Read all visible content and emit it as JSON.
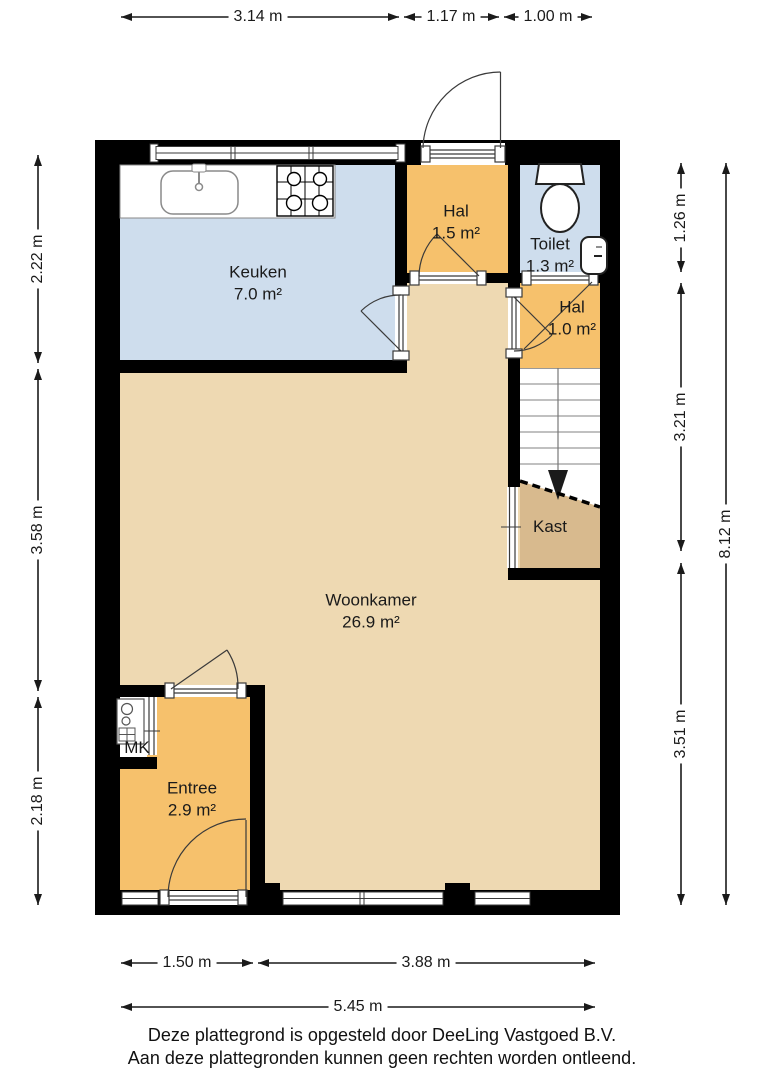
{
  "plan": {
    "rooms": {
      "keuken": {
        "name": "Keuken",
        "area": "7.0 m²"
      },
      "hal_boven": {
        "name": "Hal",
        "area": "1.5 m²"
      },
      "toilet": {
        "name": "Toilet",
        "area": "1.3 m²"
      },
      "hal_onder": {
        "name": "Hal",
        "area": "1.0 m²"
      },
      "kast": {
        "name": "Kast"
      },
      "woonkamer": {
        "name": "Woonkamer",
        "area": "26.9 m²"
      },
      "entree": {
        "name": "Entree",
        "area": "2.9 m²"
      },
      "mk": {
        "name": "MK"
      }
    },
    "dimensions": {
      "top": {
        "d1": "3.14 m",
        "d2": "1.17 m",
        "d3": "1.00 m"
      },
      "left": {
        "d1": "2.22 m",
        "d2": "3.58 m",
        "d3": "2.18 m"
      },
      "right": {
        "d1": "1.26 m",
        "d2": "3.21 m",
        "d3": "3.51 m",
        "total": "8.12 m"
      },
      "bottom": {
        "d1": "1.50 m",
        "d2": "3.88 m",
        "total": "5.45 m"
      }
    },
    "colors": {
      "wall": "#000000",
      "room_orange": "#f6c16c",
      "room_blue": "#cedded",
      "room_tan": "#eed9b2",
      "room_kast": "#d8ba8e",
      "stairs": "#ffffff",
      "background": "#ffffff"
    }
  },
  "footer": {
    "line1": "Deze plattegrond is opgesteld door DeeLing Vastgoed B.V.",
    "line2": "Aan deze plattegronden kunnen geen rechten worden ontleend."
  }
}
